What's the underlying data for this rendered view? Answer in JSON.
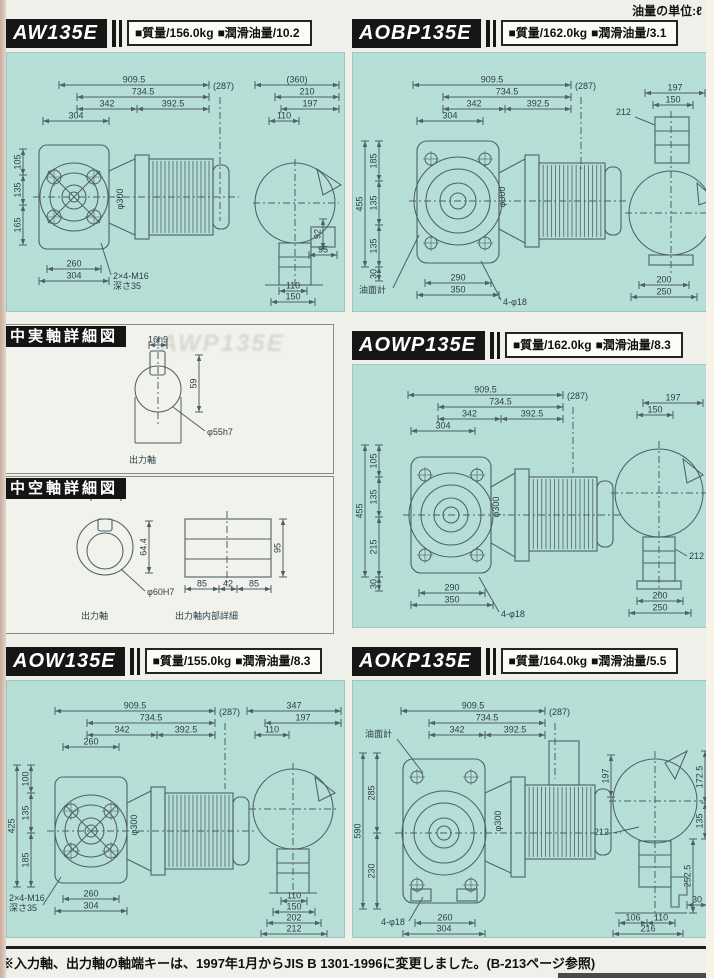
{
  "page": {
    "unit_note": "油量の単位:ℓ",
    "footer_note": "※入力軸、出力軸の軸端キーは、1997年1月からJIS B 1301-1996に変更しました。(B-213ページ参照)"
  },
  "colors": {
    "panel_bg": "#b5ded7",
    "drawing_line": "#4e6067",
    "badge_bg": "#161616",
    "accent_text": "#101010"
  },
  "panels": [
    {
      "model": "AW135E",
      "mass": "■質量/156.0kg",
      "oil": "■潤滑油量/10.2",
      "dims": [
        "909.5",
        "734.5",
        "342",
        "392.5",
        "304",
        "(287)",
        "(360)",
        "210",
        "197",
        "110",
        "92",
        "95",
        "110",
        "150",
        "105",
        "135",
        "165",
        "260",
        "304",
        "2×4-M16",
        "深さ35",
        "φ300"
      ]
    },
    {
      "model": "AOBP135E",
      "mass": "■質量/162.0kg",
      "oil": "■潤滑油量/3.1",
      "dims": [
        "909.5",
        "734.5",
        "342",
        "392.5",
        "304",
        "(287)",
        "197",
        "150",
        "212",
        "455",
        "185",
        "135",
        "135",
        "30",
        "290",
        "350",
        "4-φ18",
        "油面計",
        "200",
        "250",
        "φ300"
      ]
    },
    {
      "model": "AOWP135E",
      "mass": "■質量/162.0kg",
      "oil": "■潤滑油量/8.3",
      "dims": [
        "909.5",
        "734.5",
        "342",
        "392.5",
        "304",
        "(287)",
        "197",
        "150",
        "455",
        "105",
        "135",
        "215",
        "30",
        "290",
        "350",
        "4-φ18",
        "212",
        "200",
        "250",
        "φ300"
      ]
    },
    {
      "model": "AOW135E",
      "mass": "■質量/155.0kg",
      "oil": "■潤滑油量/8.3",
      "dims": [
        "909.5",
        "734.5",
        "342",
        "392.5",
        "260",
        "(287)",
        "347",
        "197",
        "110",
        "425",
        "100",
        "135",
        "185",
        "260",
        "304",
        "2×4-M16",
        "深さ35",
        "110",
        "150",
        "202",
        "212",
        "φ300"
      ]
    },
    {
      "model": "AOKP135E",
      "mass": "■質量/164.0kg",
      "oil": "■潤滑油量/5.5",
      "dims": [
        "909.5",
        "734.5",
        "342",
        "392.5",
        "(287)",
        "油面計",
        "590",
        "285",
        "230",
        "4-φ18",
        "260",
        "304",
        "197",
        "172.5",
        "135",
        "252.5",
        "212",
        "30",
        "106",
        "110",
        "216",
        "φ300"
      ]
    }
  ],
  "details": {
    "solid": {
      "title": "中実軸詳細図",
      "key_dim": "16h9",
      "height_dim": "59",
      "shaft_dim": "φ55h7",
      "shaft_label": "出力軸",
      "ghost": "AWP135E"
    },
    "hollow": {
      "title": "中空軸詳細図",
      "key_dim": "18JS9",
      "height_dim": "64.4",
      "bore_dim": "φ60H7",
      "shaft_label": "出力軸",
      "internal_label": "出力軸内部詳細",
      "internal_dims": [
        "85",
        "42",
        "85",
        "95"
      ]
    }
  }
}
